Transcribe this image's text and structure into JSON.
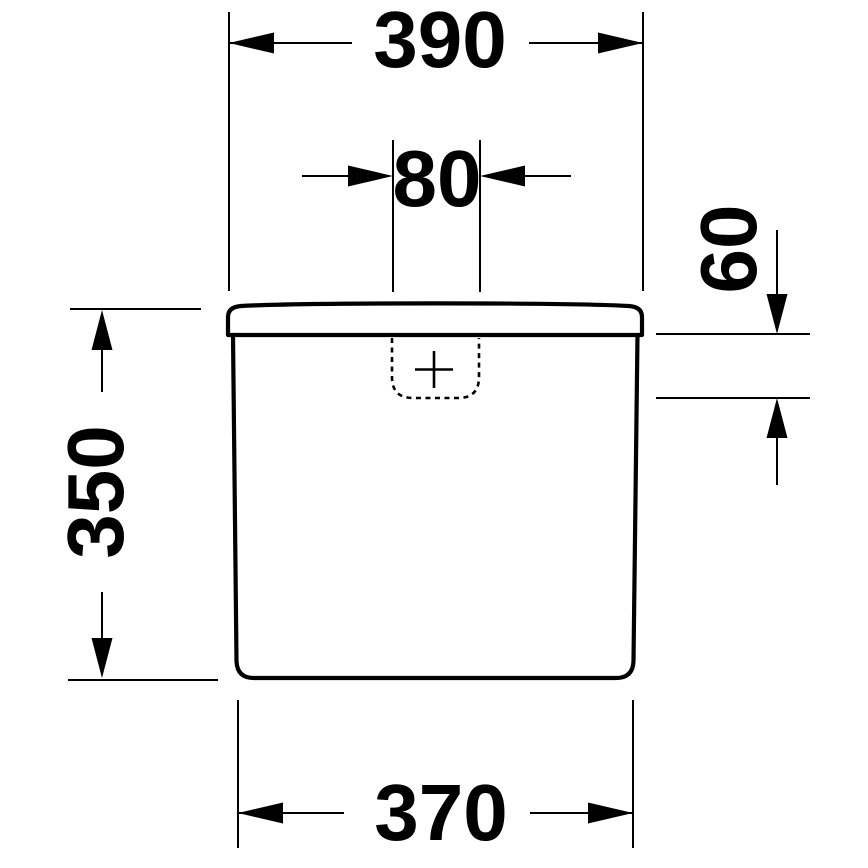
{
  "drawing": {
    "type": "technical-dimension-drawing",
    "subject": "cistern-front-view",
    "colors": {
      "line": "#000000",
      "background": "#ffffff"
    },
    "dimensions": {
      "overall_width": {
        "value": "390"
      },
      "button_recess_width": {
        "value": "80"
      },
      "lid_to_recess_depth": {
        "value": "60"
      },
      "body_height": {
        "value": "350"
      },
      "base_width": {
        "value": "370"
      }
    }
  }
}
